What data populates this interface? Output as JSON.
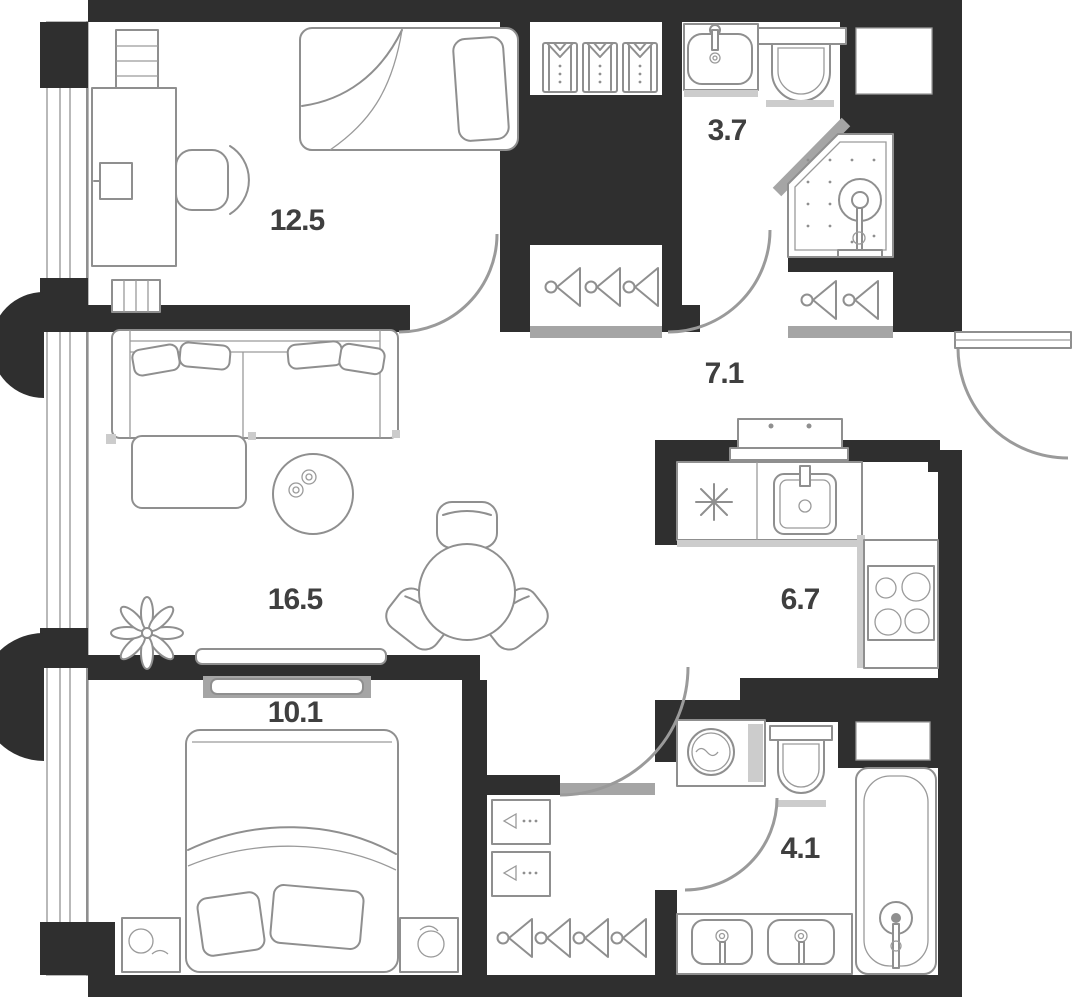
{
  "plan": {
    "type": "apartment-floor-plan",
    "rooms": [
      {
        "id": "bedroom-1",
        "area": "12.5"
      },
      {
        "id": "bathroom-1",
        "area": "3.7"
      },
      {
        "id": "hallway",
        "area": "7.1"
      },
      {
        "id": "living-room",
        "area": "16.5"
      },
      {
        "id": "kitchen",
        "area": "6.7"
      },
      {
        "id": "bedroom-2",
        "area": "10.1"
      },
      {
        "id": "bathroom-2",
        "area": "4.1"
      }
    ]
  },
  "colors": {
    "wall": "#2f2f2f",
    "furniture_line": "#8f8f8f",
    "door_arc": "#9a9a9a",
    "shadow": "#cccccc",
    "label": "#3f3f3f",
    "floor": "#ffffff"
  },
  "icons": {
    "shirt-icon": "folded shirt in wardrobe",
    "hanger-icon": "clothes hanger in closet",
    "shower-icon": "corner shower cabin with head and drain",
    "toilet-icon": "toilet with tank",
    "sink-icon": "wash basin with faucet",
    "kitchen-sink-icon": "square kitchen sink",
    "stove-icon": "4-burner cooktop",
    "fridge-snowflake-icon": "snowflake marking fridge spot",
    "washing-machine-icon": "washer drum with water line",
    "bathtub-icon": "bathtub with faucet",
    "vanity-sink-icon": "double vanity basins",
    "bed-icon": "bed with pillows and blanket",
    "sofa-icon": "corner sofa with cushions",
    "coffee-table-icon": "round table with two cups",
    "dining-table-icon": "round dining table with chairs",
    "desk-icon": "desk with monitor and chair",
    "radiator-icon": "striped radiator box",
    "plant-icon": "potted plant leaves",
    "nightstand-icon": "bedside table with lamp",
    "console-icon": "low console / dresser",
    "door-swing-arc": "door opening arc",
    "window-band-icon": "glazed facade band",
    "column-icon": "round structural column"
  }
}
